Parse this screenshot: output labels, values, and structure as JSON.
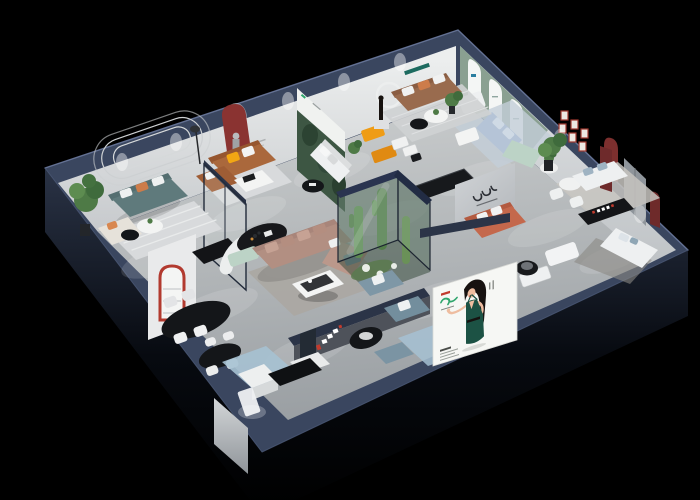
{
  "scene": {
    "type": "3d-isometric-showroom-render",
    "description": "Cutaway 3D render of a furniture showroom floor plan on a black background: multiple furnished living-room displays, a glass cactus terrarium, dining and kitchen vignettes, brand signage partitions, and a large hostess billboard on the front wall",
    "background": "#000000"
  },
  "palette": {
    "bg": "#000000",
    "floor_top": "#c7cacb",
    "floor_bottom": "#989da1",
    "wall_rim": "#3a465f",
    "wall_shell": "#222a3c",
    "wall_interior": "#e7e8e9",
    "wall_interior_shade": "#c9cccf",
    "sage_wall": "#8aa091",
    "poster_white": "#f4f6f5",
    "maroon_arch": "#8a3331",
    "red_accent": "#c23b2e",
    "mural_trees": "#3d5643",
    "mural_sky": "#f0f2f0",
    "sofa_teal": "#5f7a7c",
    "sofa_caramel": "#aa683c",
    "sofa_brown": "#996b4e",
    "sofa_white": "#eef0f1",
    "sofa_blue": "#b5c4d7",
    "sofa_mint": "#bcd3c6",
    "sofa_taupe": "#b28f82",
    "sofa_coral": "#c4684c",
    "sofa_steel": "#7e97a6",
    "cushion_orange": "#cd7c4a",
    "cushion_yellow": "#f2a713",
    "table_black": "#141619",
    "table_white": "#f3f4f3",
    "rug_light": "#d8dadc",
    "rug_warm": "#aba7a2",
    "rug_blue": "#a6c1d2",
    "plant_green": "#4e7a46",
    "cactus_green": "#5d8a52",
    "terrarium_frame": "#1c2431",
    "billboard_bg": "#f6f7f4",
    "brand_green": "#2fa56c",
    "dress_green": "#1c5244",
    "skin": "#eebda0",
    "hair": "#171210"
  },
  "rooms": [
    {
      "id": "living-display-teal",
      "objects": [
        "teal fabric sofa",
        "white and orange cushions",
        "cream chaise",
        "round white coffee table",
        "black side table",
        "striped rug",
        "tall potted plant",
        "rounded wall molding"
      ]
    },
    {
      "id": "living-display-caramel",
      "objects": [
        "caramel leather sectional",
        "yellow cushion",
        "white coffee table",
        "dark red arched wall niche",
        "floor lamp",
        "glass partition"
      ]
    },
    {
      "id": "forest-mural-vignette",
      "objects": [
        "forest mural wall with small brand logo",
        "white sofa",
        "round black coffee table",
        "potted plant"
      ]
    },
    {
      "id": "living-display-brown",
      "objects": [
        "brown leather sofa",
        "white ring wall decor",
        "black figurine",
        "yellow lounge chairs",
        "white nesting tables",
        "round side tables",
        "striped rug"
      ]
    },
    {
      "id": "gallery-display-sage",
      "objects": [
        "sage green wall",
        "three white arched posters",
        "white armchair",
        "light blue sofa",
        "mint loveseat",
        "white coffee table",
        "blue rug",
        "round side table with plant"
      ]
    },
    {
      "id": "lounge-right",
      "objects": [
        "six red framed pictures",
        "dark red arched niche",
        "white dining chairs",
        "round white table",
        "potted plant",
        "white sofas",
        "dark media console with red-and-white glyphs",
        "dark red column"
      ]
    },
    {
      "id": "bedroom-right",
      "objects": [
        "gray door panel",
        "dark red arched niche",
        "white sofa with blue pillow",
        "dark rug"
      ]
    },
    {
      "id": "center-sectional",
      "objects": [
        "taupe L-shaped sectional",
        "white coffee table with black tray",
        "gray rug",
        "curved white partition",
        "black oval display table",
        "mint bench",
        "dark credenza"
      ]
    },
    {
      "id": "terrarium",
      "objects": [
        "glass enclosure with navy frame",
        "cacti",
        "white flowering shrubs",
        "green moss bed"
      ]
    },
    {
      "id": "brand-partition",
      "objects": [
        "gray partition with dark brand logotype",
        "coral sofa with white cushions",
        "navy half wall"
      ]
    },
    {
      "id": "dining-display",
      "objects": [
        "white partition with red-trimmed arch shelf",
        "black marble console",
        "two black oval dining tables",
        "white chairs and stools"
      ]
    },
    {
      "id": "kitchen-front",
      "objects": [
        "white island",
        "white cabinets",
        "dark fridge",
        "blue patterned rug",
        "black media bench",
        "backlit panel"
      ]
    },
    {
      "id": "front-lounge",
      "objects": [
        "steel blue armchairs with white pillows",
        "round black table",
        "steel blue ottoman",
        "blue rug",
        "white display cabinets",
        "black round chair",
        "white bed bench"
      ]
    }
  ],
  "billboard": {
    "subject": "illustrated hostess with long dark hair in a dark green halter dress, one hand on hip, one arm presenting",
    "logo_color": "#2fa56c",
    "accent_color": "#c23b2e",
    "background": "#f6f7f4",
    "small_text_legible": false
  },
  "signs": [
    {
      "id": "brand-logotype-partition",
      "legible": false
    },
    {
      "id": "front-lounge-sign",
      "colors": [
        "#ffffff",
        "#c23b2e"
      ],
      "legible": false
    }
  ]
}
